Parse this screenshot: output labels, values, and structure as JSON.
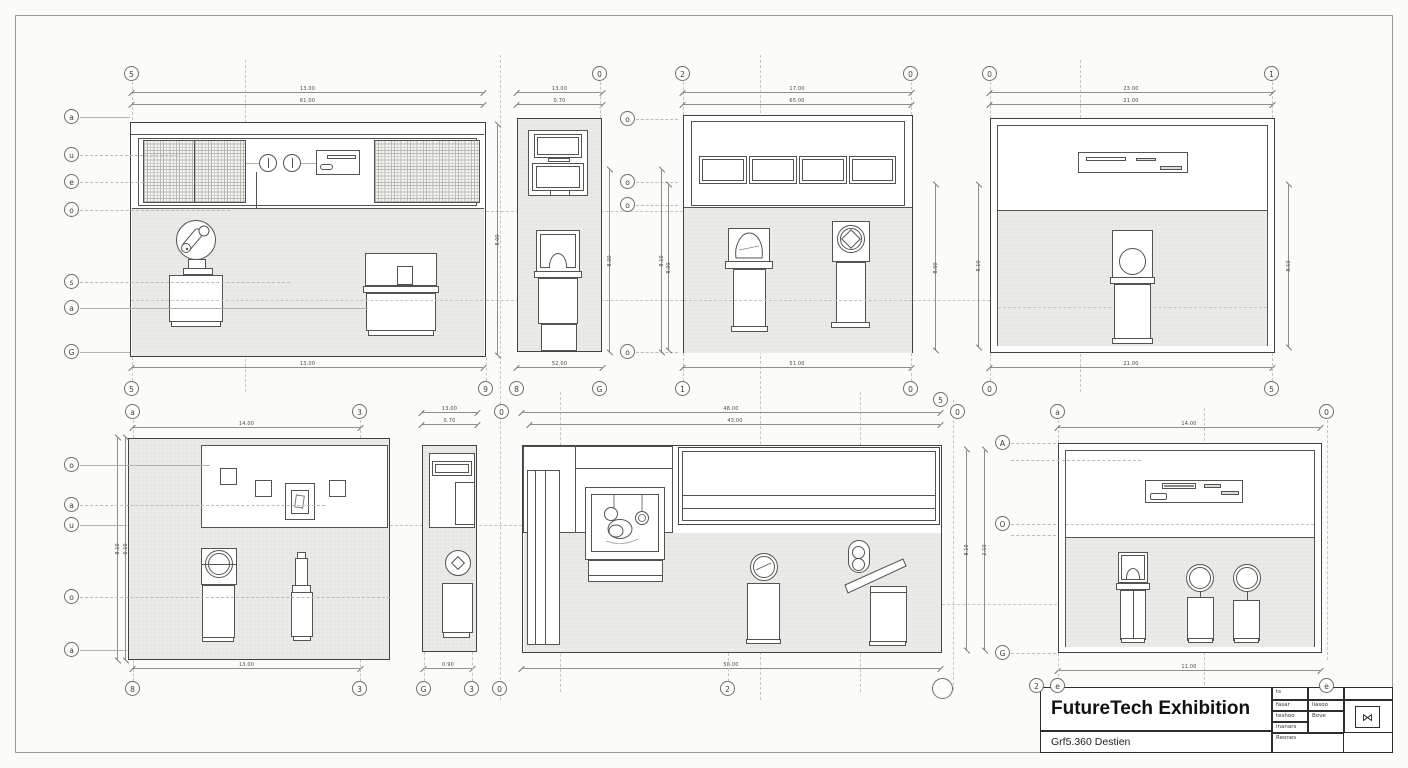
{
  "sheet": {
    "colors": {
      "paper": "#fbfbf9",
      "gray_fill": "#eaeae6",
      "line": "#55534f",
      "accent_dark": "#2e2d2b"
    },
    "title_block": {
      "title": "FutureTech Exhibition",
      "subtitle": "Grf5.360 Destien",
      "rows": [
        {
          "c1": "ts",
          "c2": ""
        },
        {
          "c1": "fasar",
          "c2": "liasoo"
        },
        {
          "c1": "teshoo",
          "c2": "Bove"
        },
        {
          "c1": "inanars",
          "c2": ""
        },
        {
          "c1": "Reones",
          "c2": ""
        }
      ],
      "stamp_icon": "⋈",
      "bubbles": [
        "2",
        "e",
        "e"
      ]
    }
  },
  "drawings": {
    "d1": {
      "name": "elevation-1",
      "dims": {
        "top1": "13.00",
        "top2": "61.00",
        "bottom": "13.00",
        "right": "8.00"
      },
      "bubbles": {
        "top": "5",
        "left": [
          "a",
          "u",
          "e",
          "o",
          "s",
          "a",
          "G"
        ],
        "bottom": [
          "5",
          "9"
        ]
      }
    },
    "d2": {
      "name": "elevation-2",
      "dims": {
        "top1": "13.00",
        "top2": "0.70",
        "bottom": "52.00",
        "side": "8.00",
        "side2": "8.10"
      },
      "bubbles": {
        "top": "0",
        "right": [
          "o",
          "o",
          "o",
          "o"
        ],
        "bottom": [
          "8",
          "G"
        ]
      }
    },
    "d3": {
      "name": "elevation-3",
      "dims": {
        "top1": "17.00",
        "top2": "65.00",
        "bottom": "51.00",
        "left": "8.00",
        "right": "8.00"
      },
      "bubbles": {
        "top": [
          "2",
          "0"
        ],
        "bottom": [
          "1",
          "0"
        ]
      }
    },
    "d4": {
      "name": "elevation-4",
      "dims": {
        "top1": "23.00",
        "top2": "21.00",
        "bottom": "21.00",
        "left": "8.10",
        "right": "8.10"
      },
      "bubbles": {
        "top": [
          "0",
          "1"
        ],
        "bottom": [
          "0",
          "5"
        ]
      }
    },
    "d5": {
      "name": "elevation-5",
      "dims": {
        "top": "14.00",
        "bottom": "13.00",
        "side1": "8.10",
        "side2": "6.10"
      },
      "bubbles": {
        "top": [
          "a",
          "3"
        ],
        "left": [
          "o",
          "a",
          "u",
          "o",
          "a"
        ],
        "bottom": [
          "8",
          "3"
        ]
      }
    },
    "d6": {
      "name": "elevation-6",
      "dims": {
        "top1": "13.00",
        "top2": "0.70",
        "bottom": "0.90"
      },
      "bubbles": {
        "top": "0",
        "bottom": [
          "G",
          "3",
          "0"
        ]
      }
    },
    "d7": {
      "name": "elevation-7",
      "dims": {
        "top1": "48.00",
        "top2": "43.00",
        "bottom": "58.00"
      },
      "bubbles": {
        "top_right": [
          "5",
          "0"
        ],
        "bottom": "2"
      }
    },
    "d8": {
      "name": "elevation-8",
      "dims": {
        "top": "14.00",
        "bottom": "11.00",
        "side1": "8.10",
        "side2": "2.10"
      },
      "bubbles": {
        "top": [
          "a",
          "0"
        ],
        "left": [
          "A",
          "O",
          "G"
        ]
      }
    }
  }
}
